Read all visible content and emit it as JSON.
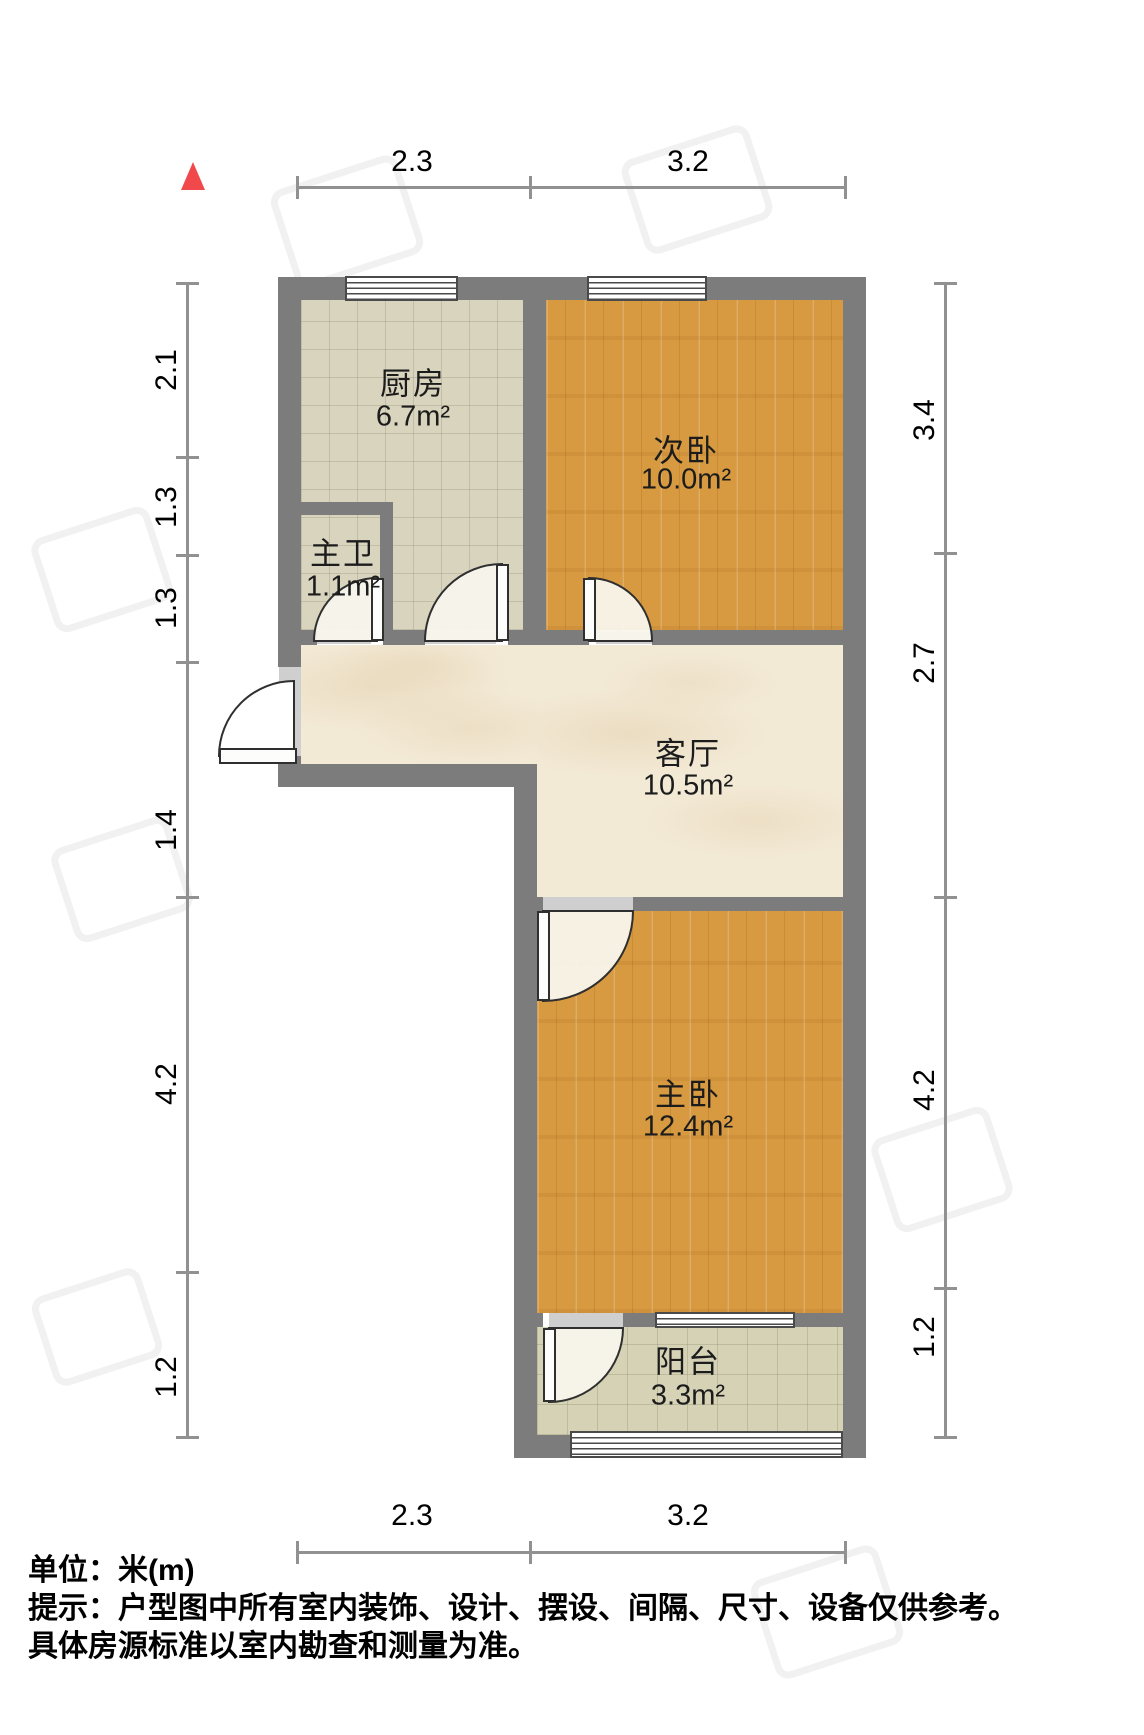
{
  "plan": {
    "unit_note": "单位：米(m)",
    "tip_line1": "提示：户型图中所有室内装饰、设计、摆设、间隔、尺寸、设备仅供参考。",
    "tip_line2": "具体房源标准以室内勘查和测量为准。"
  },
  "rooms": {
    "kitchen": {
      "label": "厨房",
      "area": "6.7m²"
    },
    "bath": {
      "label": "主卫",
      "area": "1.1m²"
    },
    "bedroom2": {
      "label": "次卧",
      "area": "10.0m²"
    },
    "living": {
      "label": "客厅",
      "area": "10.5m²"
    },
    "bedroom1": {
      "label": "主卧",
      "area": "12.4m²"
    },
    "balcony": {
      "label": "阳台",
      "area": "3.3m²"
    }
  },
  "dimensions": {
    "top": [
      "2.3",
      "3.2"
    ],
    "bottom": [
      "2.3",
      "3.2"
    ],
    "left": [
      "2.1",
      "1.3",
      "1.3",
      "1.4",
      "4.2",
      "1.2"
    ],
    "right": [
      "3.4",
      "2.7",
      "4.2",
      "1.2"
    ]
  },
  "colors": {
    "wall": "#7c7c7c",
    "wood_floor": "#d79a40",
    "tile_floor": "#d8d4be",
    "balcony_floor": "#d5d2b6",
    "marble_floor": "#f3ead6",
    "north_arrow": "#f0484b",
    "dimension_line": "#919191"
  }
}
